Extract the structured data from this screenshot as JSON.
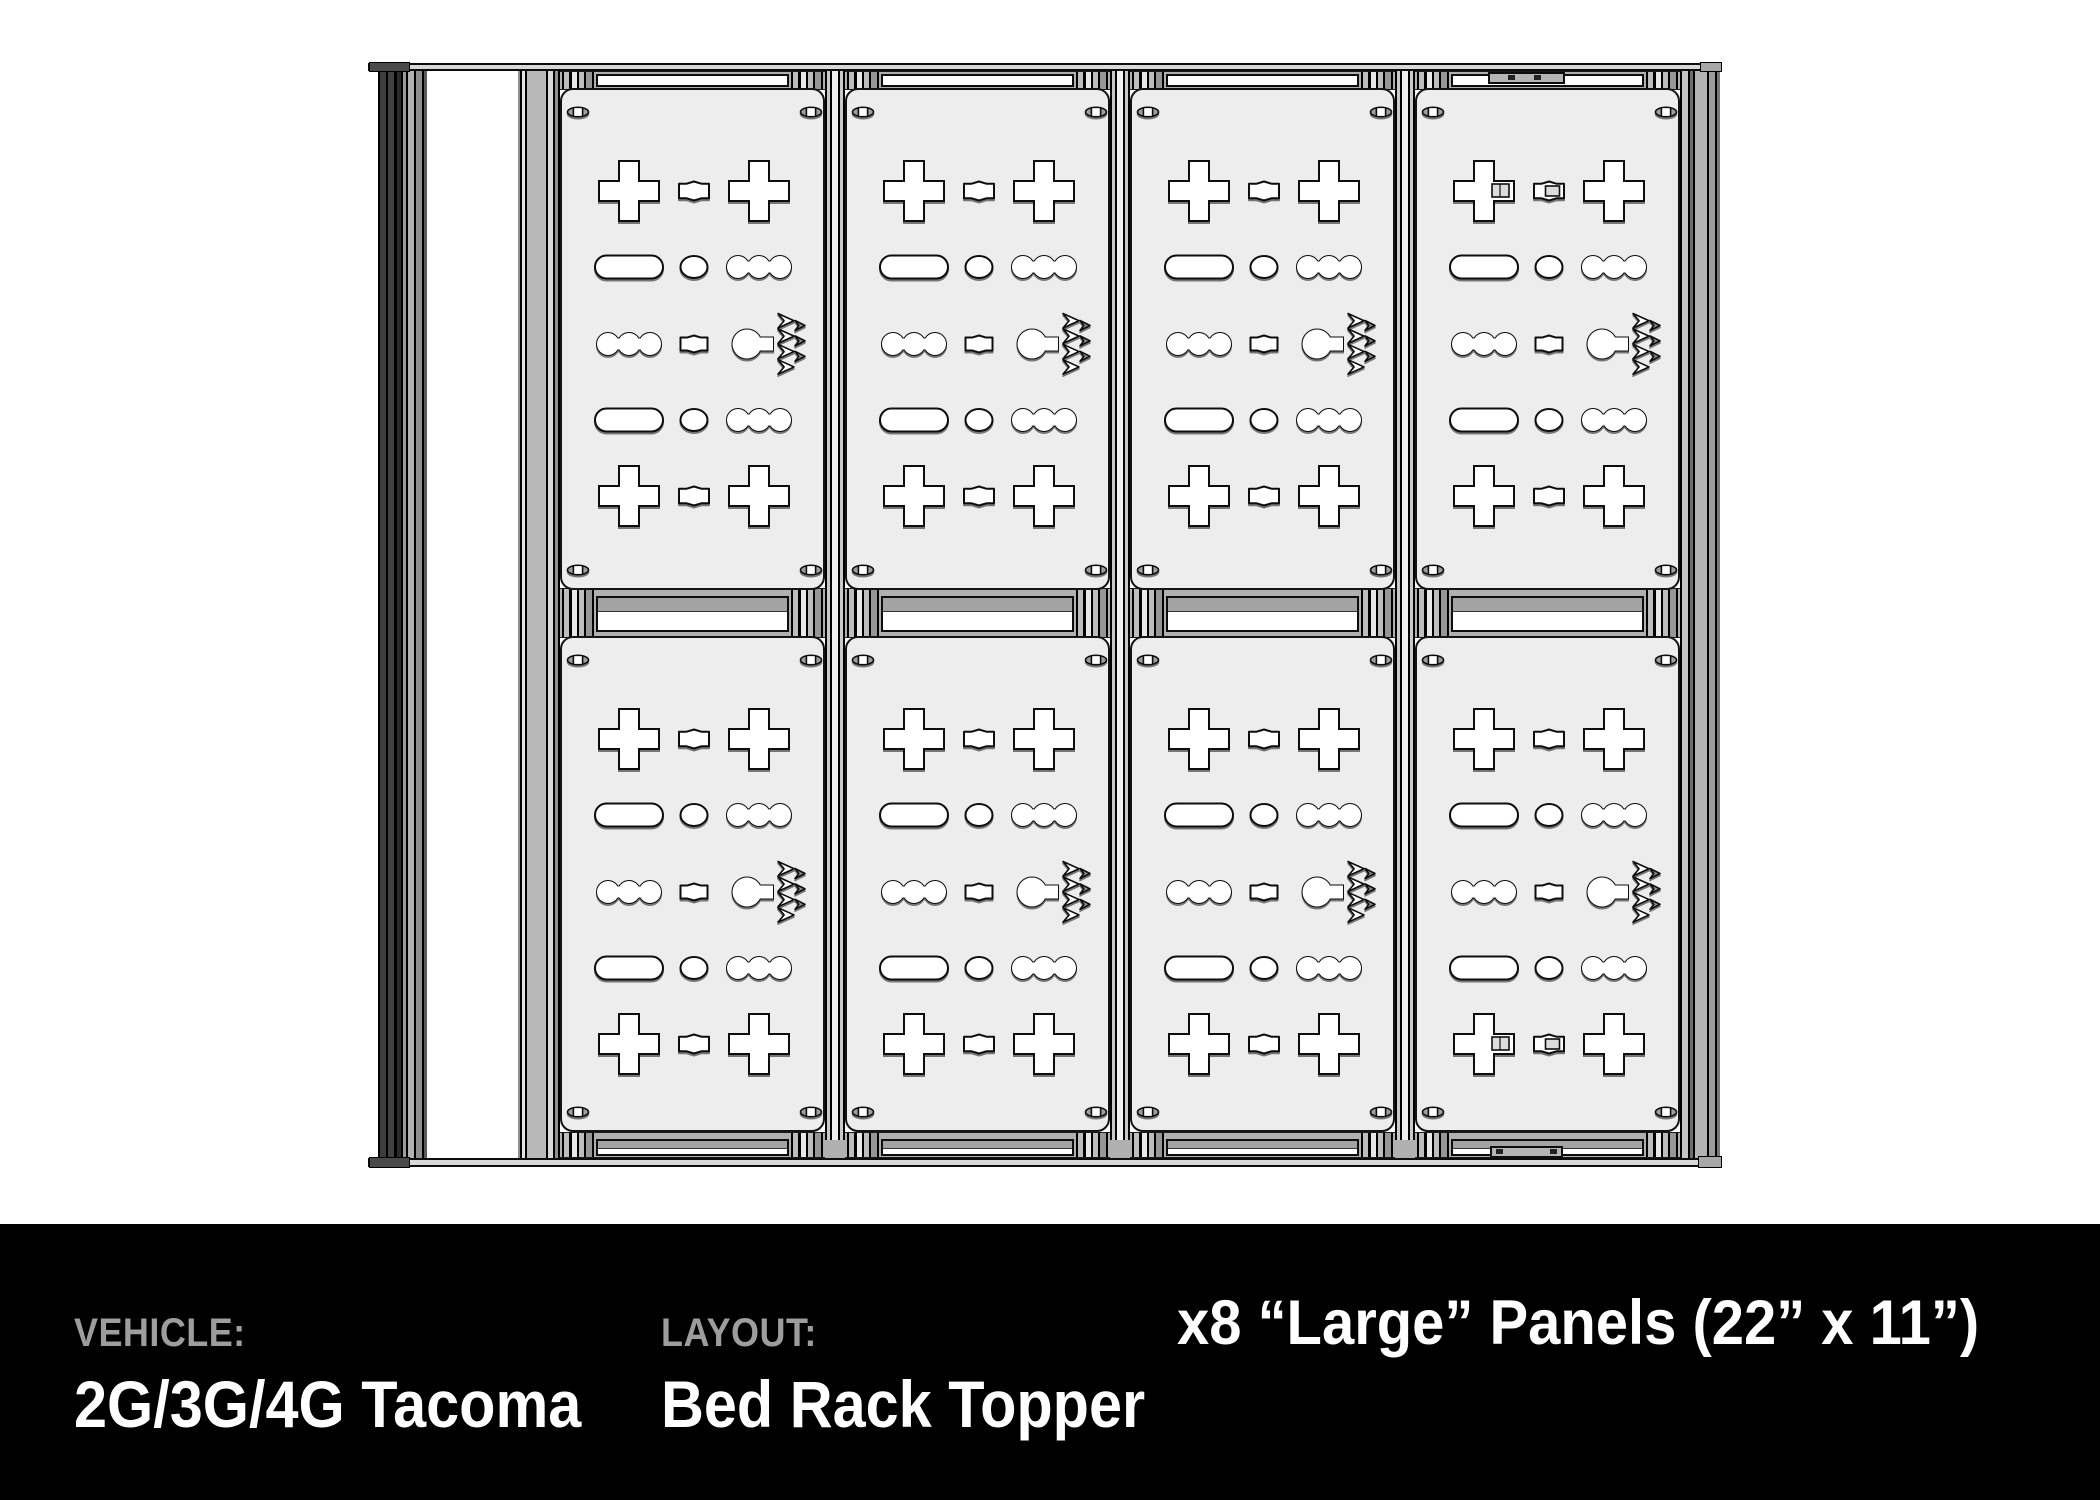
{
  "footer": {
    "vehicle": {
      "label": "VEHICLE:",
      "value": "2G/3G/4G Tacoma"
    },
    "layout": {
      "label": "LAYOUT:",
      "value": "Bed Rack Topper"
    },
    "panels_note": "x8 “Large” Panels (22” x 11”)",
    "colors": {
      "bar_bg": "#000000",
      "label": "#9d9d9d",
      "value": "#ffffff"
    }
  },
  "drawing": {
    "colors": {
      "panel_fill": "#ededed",
      "outline": "#0d0d0d",
      "cutout_fill": "#ffffff",
      "deck_fill": "#d9d9d9",
      "band_fill": "#b0b0b0",
      "logo_accent": "#8f8f8f"
    },
    "grid": {
      "columns": 4,
      "rows": 2,
      "panel_count": 8
    },
    "panel": {
      "name": "large-panel",
      "cutout_rows": [
        "plus-row",
        "slot-row",
        "slot-logo-row",
        "slot-row",
        "plus-row"
      ],
      "cutouts": [
        "cross-cutout",
        "diamond-slot-cutout",
        "pill-slot-cutout",
        "oval-cutout",
        "triple-bump-slot-cutout",
        "keyhole-slot-cutout",
        "mountain-chevron-logo-cutout",
        "corner-screw"
      ]
    },
    "accessories": [
      "top-rail-clamp",
      "bottom-rail-clamp",
      "mount-detail-top-right-panel",
      "mount-detail-bottom-right-panel"
    ]
  }
}
